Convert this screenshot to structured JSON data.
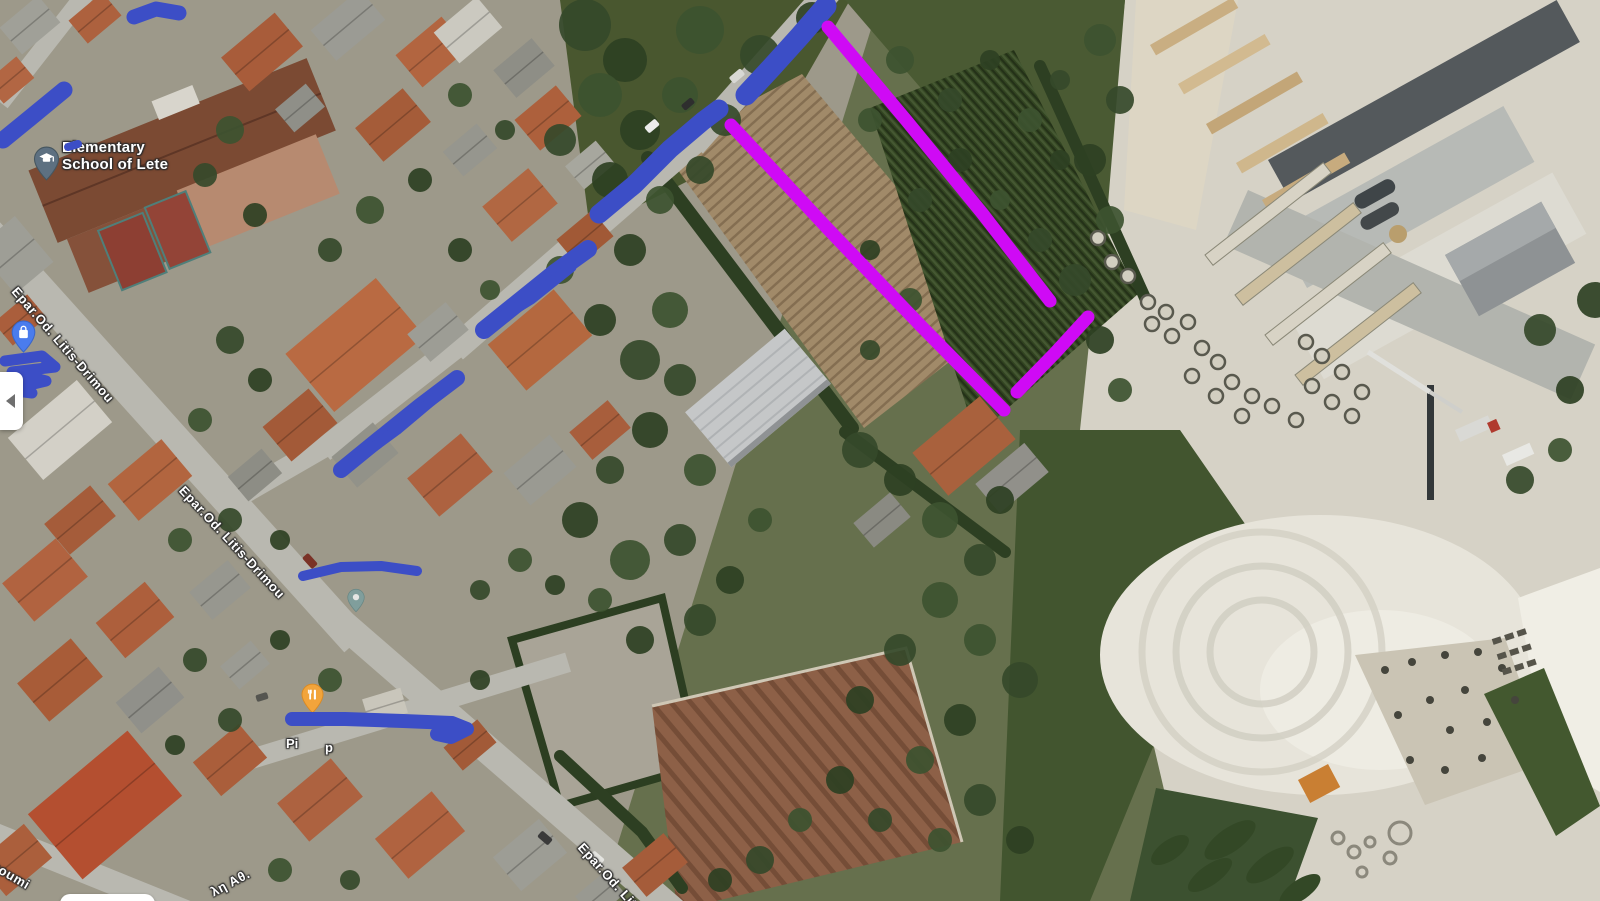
{
  "map": {
    "view_type": "satellite",
    "labels": {
      "school_line1": "Elementary",
      "school_line2": "School of Lete",
      "road_1": "Epar.Od. Litis-Drimou",
      "road_2": "Epar.Od. Litis-Drimou",
      "road_3_partial": "Epar.Od. Liti",
      "street_partial_left": "goumi",
      "street_partial_greek": "λη Αθ.",
      "poi_fragment_1": "Pi",
      "poi_fragment_2": "p"
    },
    "pins": {
      "school_pin": {
        "icon": "graduation-cap",
        "color": "#5d7081"
      },
      "blue_pin": {
        "icon": "shopping-bag",
        "color": "#4a7ced"
      },
      "teal_pin": {
        "icon": "place-dot",
        "color": "#7aa0a0"
      },
      "restaurant_pin": {
        "icon": "fork-knife",
        "color": "#f2a43b"
      }
    },
    "controls": {
      "collapse_button": {
        "icon": "chevron-left"
      }
    }
  },
  "annotations": {
    "scribbles": {
      "color": "#3c4ec6",
      "strokes": [
        {
          "name": "scribble-top-edge",
          "width": 15,
          "points": [
            [
              134,
              17
            ],
            [
              156,
              9
            ],
            [
              179,
              13
            ]
          ]
        },
        {
          "name": "scribble-top-left",
          "width": 17,
          "points": [
            [
              3,
              140
            ],
            [
              30,
              118
            ],
            [
              64,
              90
            ]
          ]
        },
        {
          "name": "scribble-top-left-dot",
          "width": 8,
          "points": [
            [
              68,
              147
            ],
            [
              78,
              144
            ]
          ]
        },
        {
          "name": "scribble-left-edge-blob",
          "width": 11,
          "points": [
            [
              5,
              361
            ],
            [
              42,
              356
            ],
            [
              55,
              367
            ],
            [
              12,
              372
            ],
            [
              46,
              381
            ],
            [
              8,
              390
            ],
            [
              32,
              393
            ]
          ]
        },
        {
          "name": "scribble-road-upper-a",
          "width": 21,
          "points": [
            [
              746,
              95
            ],
            [
              772,
              67
            ],
            [
              800,
              36
            ],
            [
              826,
              6
            ]
          ]
        },
        {
          "name": "scribble-road-upper-b",
          "width": 19,
          "points": [
            [
              599,
              214
            ],
            [
              634,
              185
            ],
            [
              670,
              149
            ],
            [
              703,
              121
            ],
            [
              719,
              109
            ]
          ]
        },
        {
          "name": "scribble-road-mid-c",
          "width": 18,
          "points": [
            [
              484,
              330
            ],
            [
              520,
              301
            ],
            [
              556,
              272
            ],
            [
              588,
              249
            ]
          ]
        },
        {
          "name": "scribble-road-mid-c2",
          "width": 11,
          "points": [
            [
              492,
              323
            ],
            [
              531,
              299
            ],
            [
              571,
              267
            ]
          ]
        },
        {
          "name": "scribble-road-mid-d",
          "width": 16,
          "points": [
            [
              341,
              470
            ],
            [
              379,
              439
            ],
            [
              420,
              406
            ],
            [
              457,
              378
            ]
          ]
        },
        {
          "name": "scribble-road-mid-d2",
          "width": 10,
          "points": [
            [
              352,
              463
            ],
            [
              397,
              430
            ],
            [
              441,
              393
            ]
          ]
        },
        {
          "name": "scribble-road-e",
          "width": 10,
          "points": [
            [
              303,
              576
            ],
            [
              341,
              567
            ],
            [
              381,
              566
            ],
            [
              417,
              571
            ]
          ]
        },
        {
          "name": "scribble-bottom-bar",
          "width": 14,
          "points": [
            [
              292,
              719
            ],
            [
              345,
              719
            ],
            [
              403,
              721
            ],
            [
              452,
              723
            ],
            [
              467,
              729
            ],
            [
              451,
              737
            ],
            [
              437,
              734
            ]
          ]
        }
      ]
    },
    "highlights": {
      "color": "#cf0af5",
      "strokes": [
        {
          "name": "parcel-line-left",
          "width": 13,
          "points": [
            [
              731,
              125
            ],
            [
              828,
              229
            ],
            [
              922,
              327
            ],
            [
              1004,
              410
            ]
          ]
        },
        {
          "name": "parcel-line-right",
          "width": 13,
          "points": [
            [
              828,
              27
            ],
            [
              906,
              120
            ],
            [
              982,
              213
            ],
            [
              1050,
              301
            ]
          ]
        },
        {
          "name": "parcel-line-bottom",
          "width": 13,
          "points": [
            [
              1088,
              317
            ],
            [
              1055,
              353
            ],
            [
              1017,
              392
            ]
          ]
        }
      ]
    }
  }
}
